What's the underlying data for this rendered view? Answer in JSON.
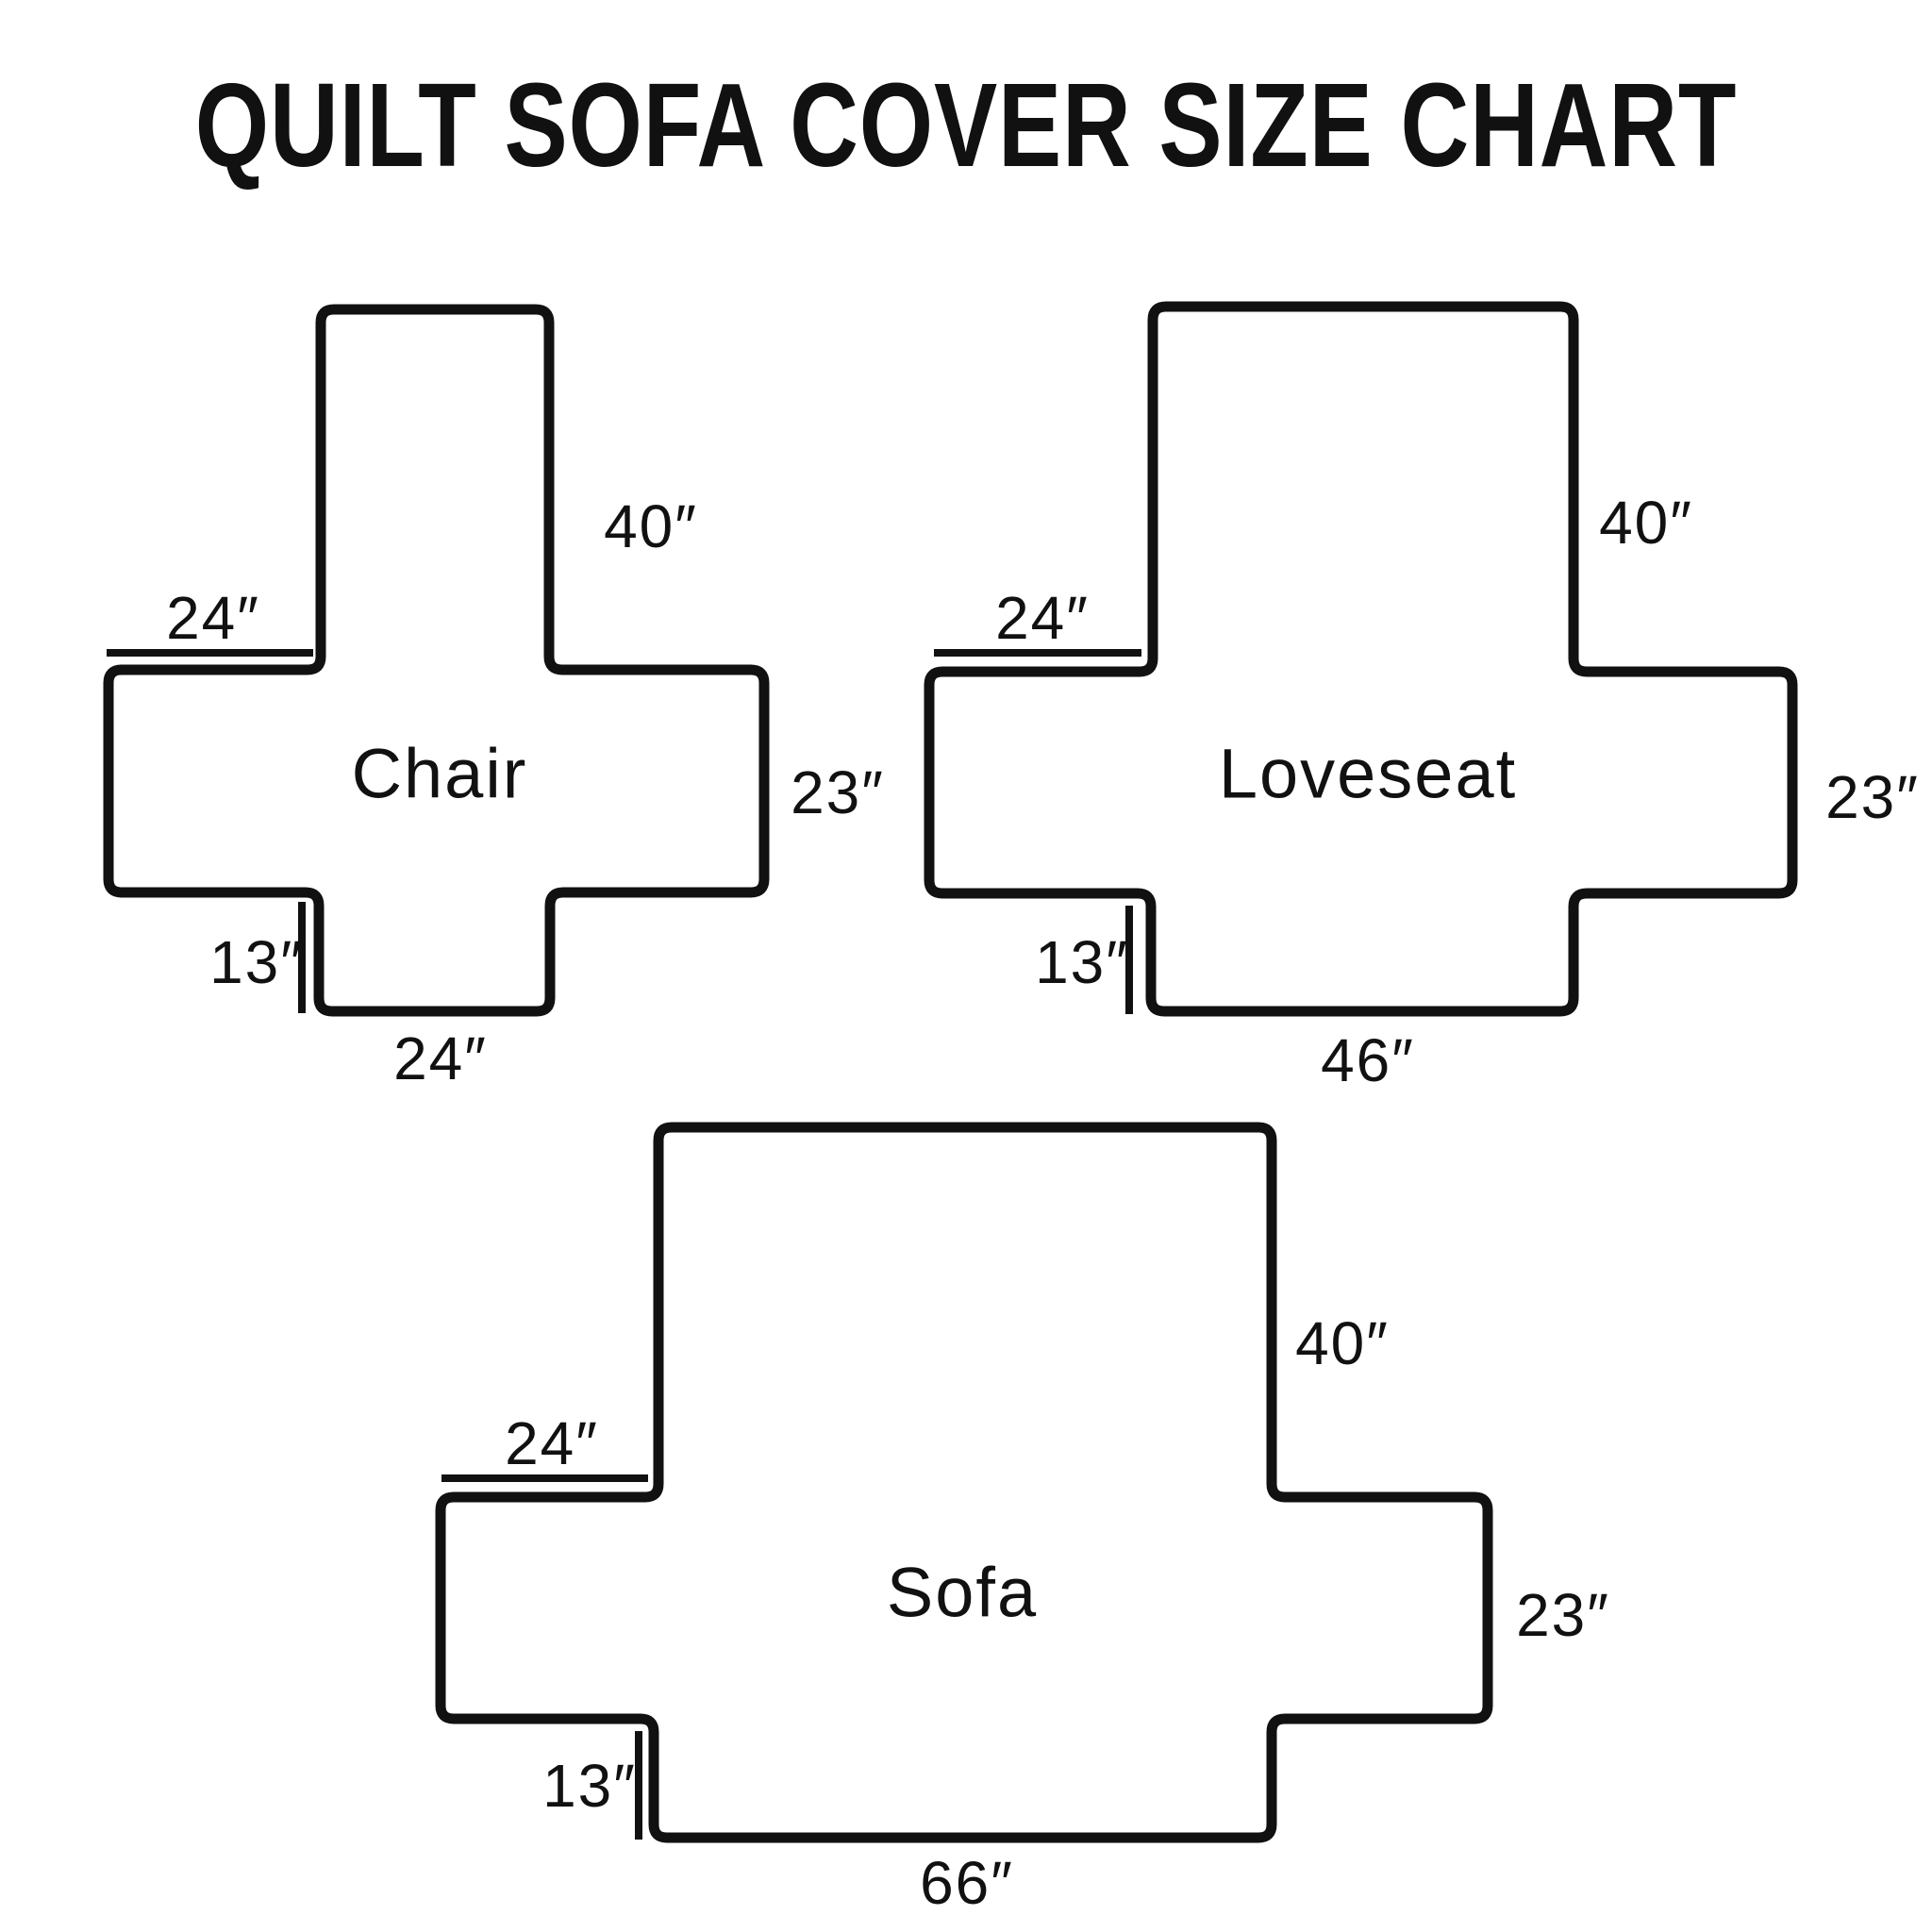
{
  "title": "QUILT SOFA COVER SIZE CHART",
  "colors": {
    "ink": "#111111",
    "background": "#ffffff"
  },
  "diagrams": [
    {
      "name": "Chair",
      "labels": {
        "back_height": "40″",
        "arm_top_width": "24″",
        "arm_side_height": "23″",
        "skirt_height": "13″",
        "bottom_width": "24″"
      }
    },
    {
      "name": "Loveseat",
      "labels": {
        "back_height": "40″",
        "arm_top_width": "24″",
        "arm_side_height": "23″",
        "skirt_height": "13″",
        "bottom_width": "46″"
      }
    },
    {
      "name": "Sofa",
      "labels": {
        "back_height": "40″",
        "arm_top_width": "24″",
        "arm_side_height": "23″",
        "skirt_height": "13″",
        "bottom_width": "66″"
      }
    }
  ]
}
